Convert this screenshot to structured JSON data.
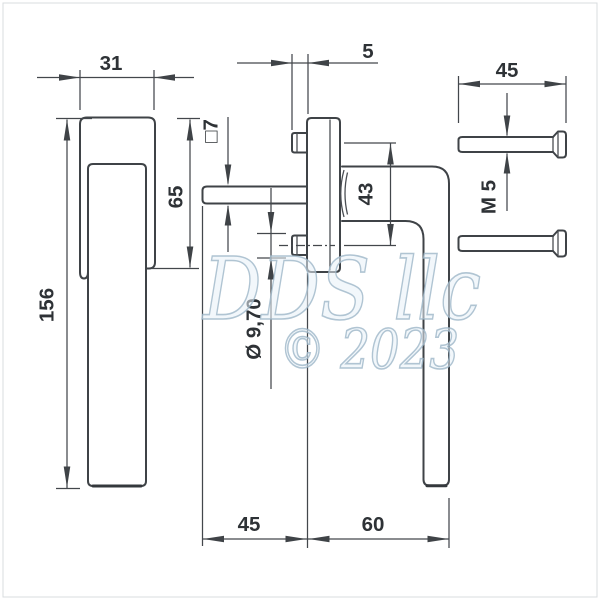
{
  "page": {
    "background": "#ffffff",
    "border_color": "#d6d9dc"
  },
  "drawing": {
    "type": "technical-drawing",
    "subject": "window-handle-with-rosette-and-screws",
    "line_color": "#3f4347",
    "text_color": "#2e3236",
    "dimensions": {
      "grip_width": "31",
      "plate_edge": "5",
      "screw_length": "45",
      "handle_height": "156",
      "top_to_axis": "65",
      "spindle_square": "□7",
      "screw_spacing": "43",
      "screw_thread": "M 5",
      "hole_diameter": "Ø 9,70",
      "spindle_to_plate": "45",
      "projection": "60"
    },
    "watermark": {
      "line1": "DDS llc",
      "line2": "© 2023",
      "color": "#9db6c8"
    }
  }
}
